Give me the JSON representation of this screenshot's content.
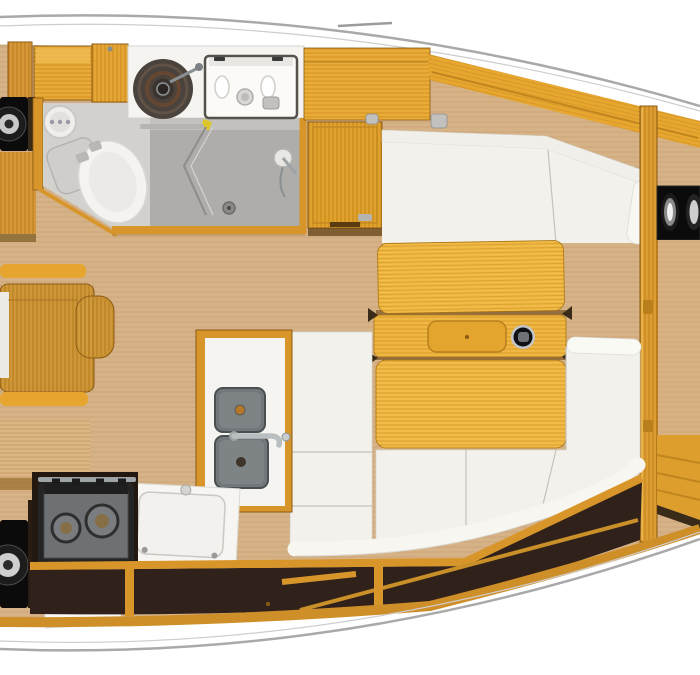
{
  "meta": {
    "title": "Sailboat interior floor plan (top-down render)",
    "orientation": "bow to the right, stern cropped at left"
  },
  "colors": {
    "background": "#ffffff",
    "hull_line": "#a9a9a9",
    "hull_line_faint": "#cdcdcd",
    "floor": "#d6b287",
    "wood_bright": "#e6a52e",
    "wood_mid": "#cf9030",
    "wood_deep": "#b97f1c",
    "table_wood": "#efb63e",
    "cushion": "#f2f1ec",
    "cushion_highlight": "#f8f7f2",
    "head_floor": "#c8c7c3",
    "shower_floor": "#aeada9",
    "fixture_white": "#f5f4f0",
    "basin_gray": "#71777a",
    "stove_black": "#242424",
    "stove_metal": "#6e7173",
    "speaker_black": "#0b0b0b",
    "stowage_dark": "#30211a",
    "chrome": "#9ea3a6",
    "berth_tan": "#d9b183"
  },
  "components": {
    "head": [
      "toilet",
      "cistern",
      "round-washbasin",
      "vanity-sink-unit",
      "shower-folding-door",
      "shower-drain",
      "shower-mixer"
    ],
    "galley": [
      "two-burner-stove",
      "double-sink",
      "faucet",
      "fridge-lid-counter",
      "locker-door"
    ],
    "salon": [
      "u-shaped-settee",
      "folding-table",
      "table-tray",
      "compass-knob",
      "nav-desk"
    ],
    "forward_cabin": [
      "bulkhead",
      "speaker-panel",
      "v-berth"
    ],
    "aft": [
      "speaker",
      "lockers",
      "stowage-shelf"
    ]
  }
}
